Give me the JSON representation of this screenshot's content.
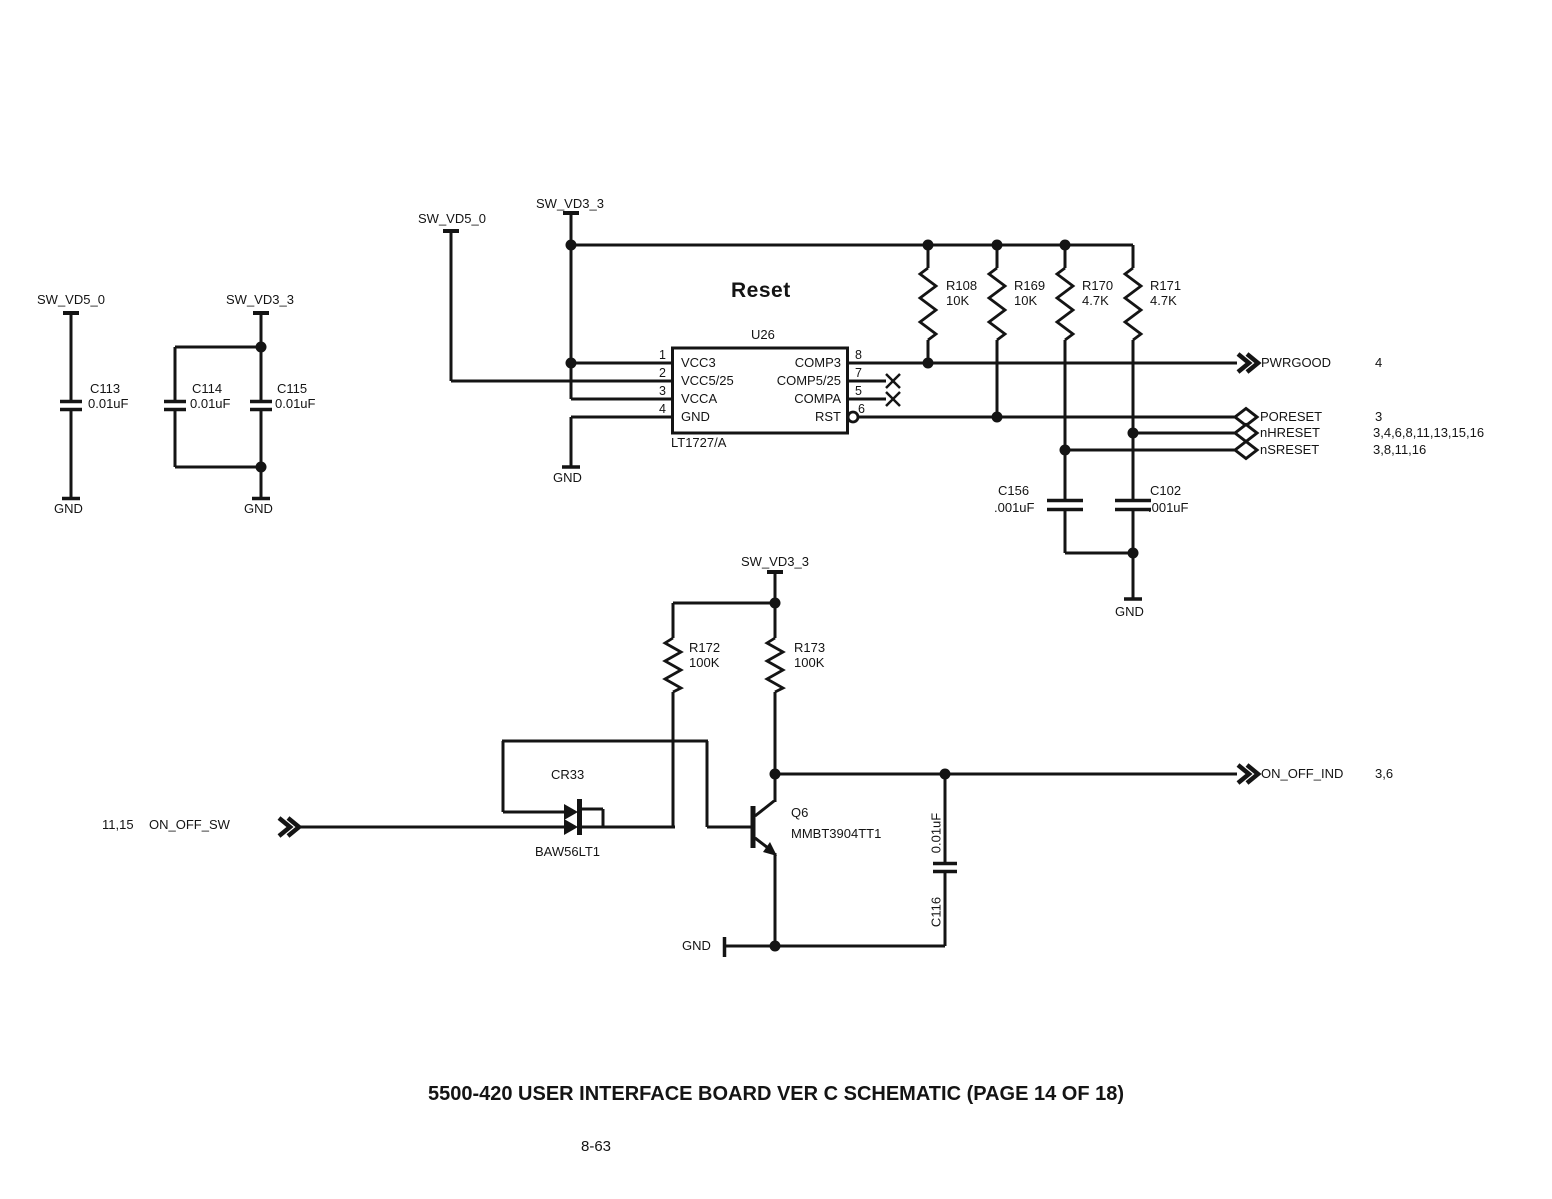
{
  "title_block": {
    "title": "5500-420 USER INTERFACE BOARD VER C SCHEMATIC (PAGE 14 OF 18)",
    "page_number": "8-63"
  },
  "decoupling": {
    "rail_5v": "SW_VD5_0",
    "rail_3v3": "SW_VD3_3",
    "gnd_left": "GND",
    "gnd_right": "GND",
    "c113": {
      "ref": "C113",
      "value": "0.01uF"
    },
    "c114": {
      "ref": "C114",
      "value": "0.01uF"
    },
    "c115": {
      "ref": "C115",
      "value": "0.01uF"
    }
  },
  "reset": {
    "heading": "Reset",
    "rail_5v": "SW_VD5_0",
    "rail_3v3": "SW_VD3_3",
    "gnd_chip": "GND",
    "gnd_caps": "GND",
    "u26": {
      "ref": "U26",
      "part": "LT1727/A",
      "left_pins": [
        {
          "num": "1",
          "name": "VCC3"
        },
        {
          "num": "2",
          "name": "VCC5/25"
        },
        {
          "num": "3",
          "name": "VCCA"
        },
        {
          "num": "4",
          "name": "GND"
        }
      ],
      "right_pins": [
        {
          "num": "8",
          "name": "COMP3"
        },
        {
          "num": "7",
          "name": "COMP5/25"
        },
        {
          "num": "5",
          "name": "COMPA"
        },
        {
          "num": "6",
          "name": "RST"
        }
      ]
    },
    "r108": {
      "ref": "R108",
      "value": "10K"
    },
    "r169": {
      "ref": "R169",
      "value": "10K"
    },
    "r170": {
      "ref": "R170",
      "value": "4.7K"
    },
    "r171": {
      "ref": "R171",
      "value": "4.7K"
    },
    "c156": {
      "ref": "C156",
      "value": ".001uF"
    },
    "c102": {
      "ref": "C102",
      "value": ".001uF"
    },
    "outputs": [
      {
        "name": "PWRGOOD",
        "pages": "4"
      },
      {
        "name": "PORESET",
        "pages": "3"
      },
      {
        "name": "nHRESET",
        "pages": "3,4,6,8,11,13,15,16"
      },
      {
        "name": "nSRESET",
        "pages": "3,8,11,16"
      }
    ]
  },
  "on_off": {
    "rail_3v3": "SW_VD3_3",
    "r172": {
      "ref": "R172",
      "value": "100K"
    },
    "r173": {
      "ref": "R173",
      "value": "100K"
    },
    "cr33": {
      "ref": "CR33",
      "part": "BAW56LT1"
    },
    "q6": {
      "ref": "Q6",
      "part": "MMBT3904TT1"
    },
    "c116": {
      "ref": "C116",
      "value": "0.01uF"
    },
    "input": {
      "pages": "11,15",
      "name": "ON_OFF_SW"
    },
    "output": {
      "name": "ON_OFF_IND",
      "pages": "3,6"
    },
    "gnd": "GND"
  }
}
